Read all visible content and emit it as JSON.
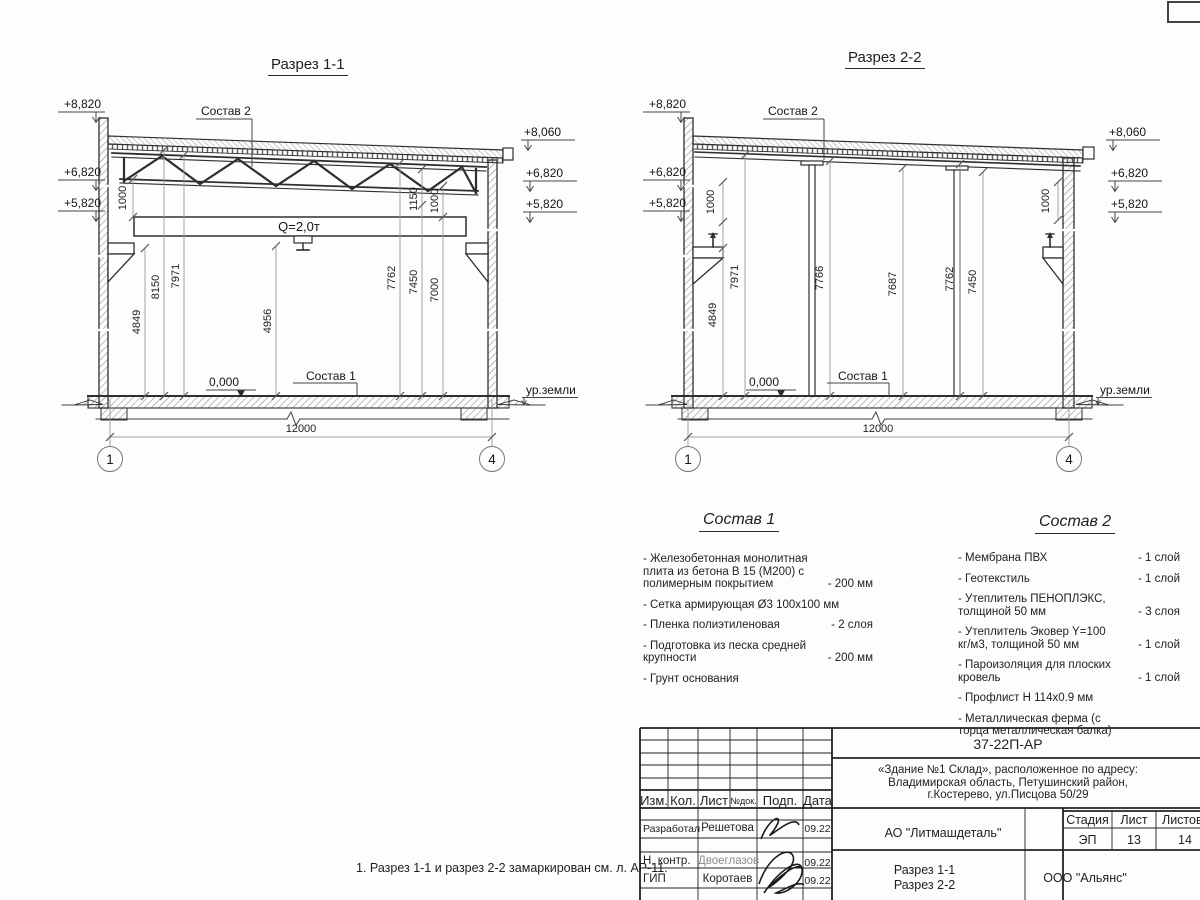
{
  "page": {
    "note": "1. Разрез 1-1 и разрез 2-2 замаркирован см. л. АР-11."
  },
  "s1": {
    "title": "Разрез 1-1",
    "sostav2": "Состав 2",
    "sostav1": "Состав 1",
    "crane": "Q=2,0т",
    "zero": "0,000",
    "ground": "ур.земли",
    "span": "12000",
    "ax_l": "1",
    "ax_r": "4",
    "el_l1": "+8,820",
    "el_l2": "+6,820",
    "el_l3": "+5,820",
    "el_r1": "+8,060",
    "el_r2": "+6,820",
    "el_r3": "+5,820",
    "d_1000l": "1000",
    "d_4849": "4849",
    "d_8150": "8150",
    "d_7971": "7971",
    "d_4956": "4956",
    "d_7762": "7762",
    "d_7450": "7450",
    "d_7000": "7000",
    "d_1150": "1150",
    "d_1000r": "1000"
  },
  "s2": {
    "title": "Разрез 2-2",
    "sostav2": "Состав 2",
    "sostav1": "Состав 1",
    "zero": "0,000",
    "ground": "ур.земли",
    "span": "12000",
    "ax_l": "1",
    "ax_r": "4",
    "el_l1": "+8,820",
    "el_l2": "+6,820",
    "el_l3": "+5,820",
    "el_r1": "+8,060",
    "el_r2": "+6,820",
    "el_r3": "+5,820",
    "d_1000l": "1000",
    "d_4849": "4849",
    "d_7971": "7971",
    "d_7766": "7766",
    "d_7687": "7687",
    "d_7762": "7762",
    "d_7450": "7450",
    "d_1000r": "1000"
  },
  "sostav1": {
    "title": "Состав 1",
    "items": [
      {
        "name": "- Железобетонная  монолитная плита из бетона В 15 (М200) с полимерным покрытием",
        "value": "- 200 мм"
      },
      {
        "name": "- Сетка армирующая Ø3 100х100 мм",
        "value": ""
      },
      {
        "name": "- Пленка полиэтиленовая",
        "value": "-  2 слоя"
      },
      {
        "name": "- Подготовка из песка средней крупности",
        "value": "- 200 мм"
      },
      {
        "name": "- Грунт основания",
        "value": ""
      }
    ]
  },
  "sostav2": {
    "title": "Состав 2",
    "items": [
      {
        "name": "- Мембрана ПВХ",
        "value": "- 1 слой"
      },
      {
        "name": "- Геотекстиль",
        "value": "- 1 слой"
      },
      {
        "name": "- Утеплитель ПЕНОПЛЭКС, толщиной 50 мм",
        "value": "- 3 слоя"
      },
      {
        "name": "- Утеплитель Эковер Y=100 кг/м3, толщиной 50 мм",
        "value": "- 1 слой"
      },
      {
        "name": "- Пароизоляция для плоских кровель",
        "value": "- 1 слой"
      },
      {
        "name": "- Профлист Н 114х0.9 мм",
        "value": ""
      },
      {
        "name": "- Металлическая ферма (с торца металлическая балка)",
        "value": ""
      }
    ]
  },
  "tb": {
    "code": "37-22П-АР",
    "obj1": "«Здание №1 Склад», расположенное по адресу:",
    "obj2": "Владимирская область, Петушинский район,",
    "obj3": "г.Костерево, ул.Писцова 50/29",
    "company": "АО \"Литмашдеталь\"",
    "view1": "Разрез 1-1",
    "view2": "Разрез 2-2",
    "org": "ООО \"Альянс\"",
    "h_stage": "Стадия",
    "h_sheet": "Лист",
    "h_sheets": "Листов",
    "stage": "ЭП",
    "sheet": "13",
    "sheets": "14",
    "c_izm": "Изм.",
    "c_kol": "Кол.",
    "c_list": "Лист",
    "c_ndok": "№док.",
    "c_podp": "Подп.",
    "c_data": "Дата",
    "r1_role": "Разработал",
    "r1_name": "Решетова",
    "r1_date": "09.22",
    "r2_role": "Н. контр.",
    "r2_name": "Двоеглазов",
    "r2_date": "09.22",
    "r3_role": "ГИП",
    "r3_name": "Коротаев",
    "r3_date": "09.22"
  }
}
